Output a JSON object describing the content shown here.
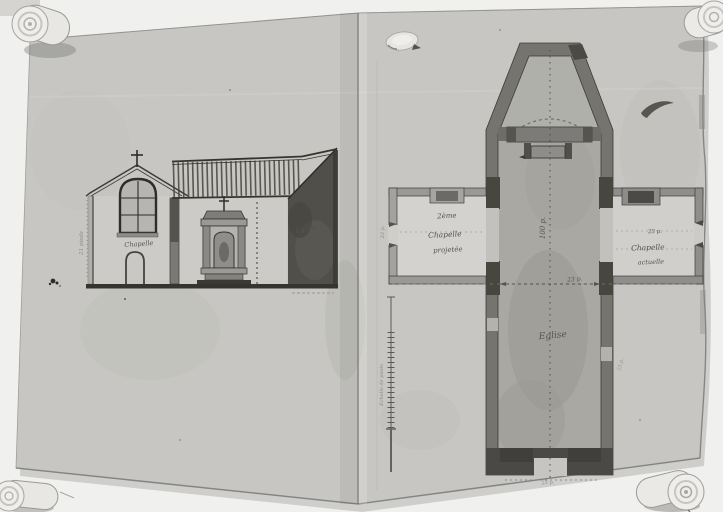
{
  "document": {
    "type": "archival photograph of an ink-and-wash architectural drawing",
    "subject": "church elevation and cruciform floor plan on a two-leaf manuscript"
  },
  "elevation": {
    "chapel_label": "Chapelle",
    "church_label": "Eglise",
    "height_dimension": "21 pieds"
  },
  "plan": {
    "left_chapel": {
      "line1": "2ème",
      "line2": "Chapelle",
      "line3": "projetée",
      "side_dimension": "23 p."
    },
    "right_chapel": {
      "dimension": "23 p.",
      "line1": "Chapelle",
      "line2": "actuelle"
    },
    "nave_label": "Eglise",
    "crossing_dimension": "23 p.",
    "length_dimension": "100 p.",
    "entrance_dimension": "23 p.",
    "side_note": "23 p.",
    "scale_label": "Echelle de pieds"
  },
  "colors": {
    "backdrop": "#f0f0ee",
    "paper": "#c7c6c2",
    "ink": "#35342f",
    "wall_dark": "#4a4945",
    "wall_medium": "#908e8a",
    "wash_nave": "#a9a8a3",
    "handwriting": "#55534f"
  }
}
